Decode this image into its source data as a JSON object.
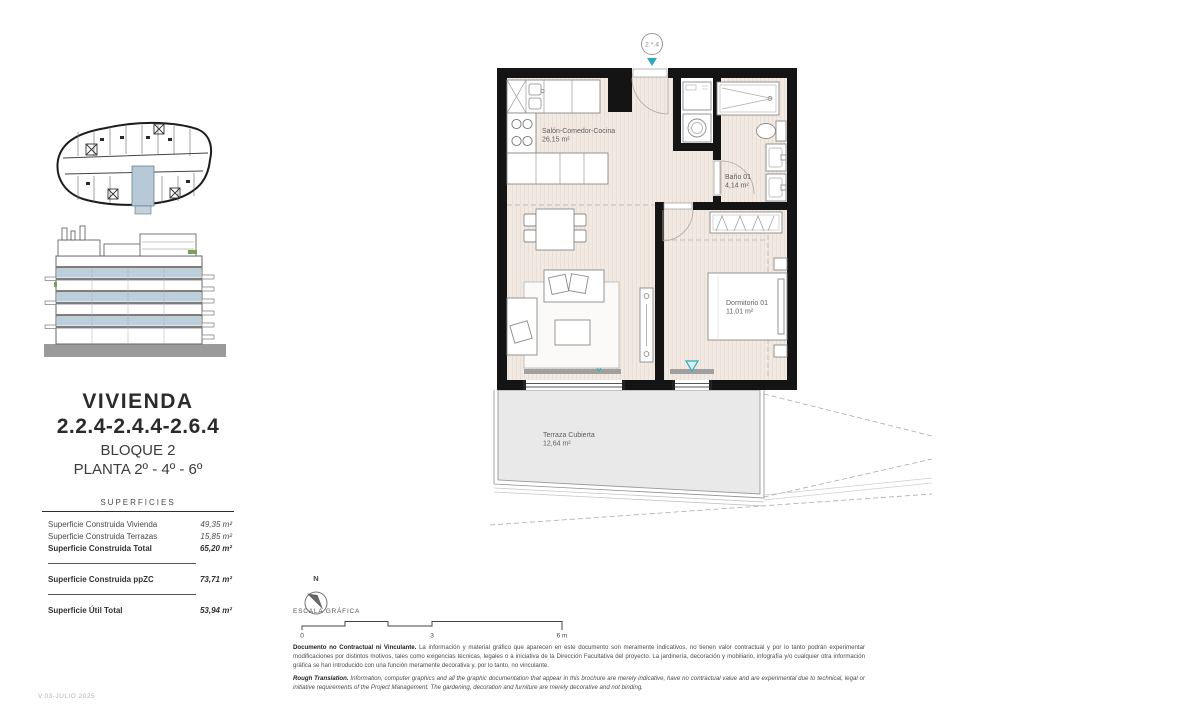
{
  "page": {
    "version_note": "V.03-JULIO 2025"
  },
  "sidebar": {
    "title": "VIVIENDA",
    "unit_numbers": "2.2.4-2.4.4-2.6.4",
    "block": "BLOQUE 2",
    "floors": "PLANTA 2º - 4º - 6º",
    "surfaces": {
      "heading": "SUPERFICIES",
      "rows": [
        {
          "label": "Superficie Construida Vivienda",
          "value": "49,35 m²"
        },
        {
          "label": "Superficie Construida Terrazas",
          "value": "15,85 m²"
        },
        {
          "label": "Superficie Construida Total",
          "value": "65,20 m²"
        },
        {
          "label": "Superficie Construida ppZC",
          "value": "73,71 m²"
        },
        {
          "label": "Superficie Útil Total",
          "value": "53,94 m²"
        }
      ]
    }
  },
  "plan": {
    "unit_bubble": "2.*.4",
    "rooms": {
      "salon": {
        "name": "Salón-Comedor-Cocina",
        "area": "26,15 m²"
      },
      "bano": {
        "name": "Baño 01",
        "area": "4,14 m²"
      },
      "dormitorio": {
        "name": "Dormitorio 01",
        "area": "11,01 m²"
      },
      "terraza": {
        "name": "Terraza Cubierta",
        "area": "12,64 m²"
      }
    }
  },
  "legend": {
    "north": "N",
    "scale_label": "ESCALA GRÁFICA",
    "ticks": [
      "0",
      "3",
      "6 m"
    ]
  },
  "disclaimer": {
    "es_lead": "Documento no Contractual ni Vinculante.",
    "es_body": " La información y material gráfico que aparecen en este documento son meramente indicativos, no tienen valor contractual y por lo tanto podrán experimentar modificaciones por distintos motivos, tales como exigencias técnicas, legales o a iniciativa de la Dirección Facultativa del proyecto. La jardinería, decoración y mobiliario, infografía y/o cualquier otra información gráfica se han introducido con una función meramente decorativa y, por lo tanto, no vinculante.",
    "en_lead": "Rough Translation.",
    "en_body": " Information, computer graphics and all the graphic documentation that appear in this brochure are merely indicative, have no contractual value and are experimental due to technical, legal or initiative requirements of the Project Management. The gardening, decoration and furniture are merely decorative and not binding."
  },
  "colors": {
    "teal": "#2FA9BC",
    "unit_highlight": "#B7C8D6",
    "wall": "#141414",
    "floor": "#F1E9E2",
    "terrace": "#E9E9E9"
  }
}
